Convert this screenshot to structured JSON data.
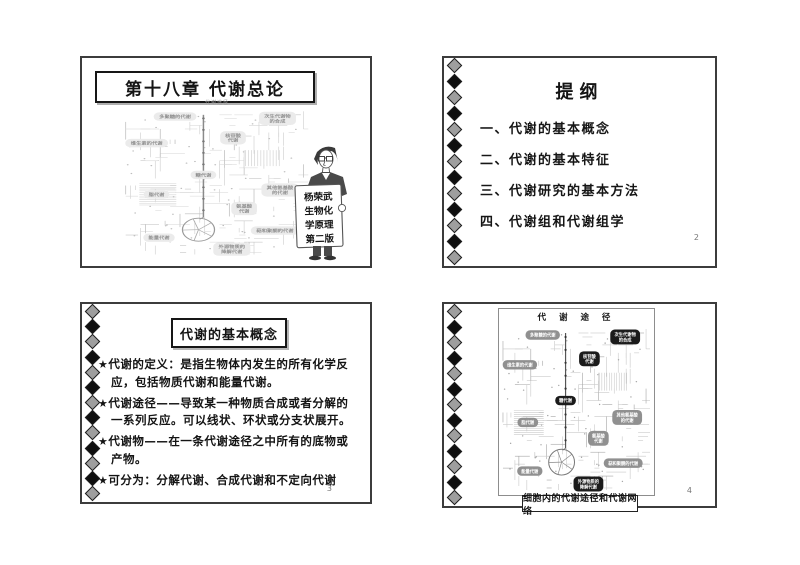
{
  "colors": {
    "slide_border": "#3c3c3c",
    "diamond_gray": "#9e9e9e",
    "diamond_black": "#0f0f0f",
    "pill_dark": "#1b1b1b",
    "pill_gray": "#909090",
    "map_line_light": "#cdcdcd"
  },
  "slides": {
    "slide1": {
      "title": "第十八章  代谢总论",
      "map_title": "代谢途径",
      "book_sign_lines": [
        "杨荣武",
        "生物化",
        "学原理",
        "第二版"
      ]
    },
    "slide2": {
      "title": "提纲",
      "items": [
        "一、代谢的基本概念",
        "二、代谢的基本特征",
        "三、代谢研究的基本方法",
        "四、代谢组和代谢组学"
      ],
      "page_number": "2"
    },
    "slide3": {
      "title": "代谢的基本概念",
      "bullet_marker": "★",
      "bullets": [
        "代谢的定义：是指生物体内发生的所有化学反应，包括物质代谢和能量代谢。",
        "代谢途径——导致某一种物质合成或者分解的一系列反应。可以线状、环状或分支状展开。",
        "代谢物——在一条代谢途径之中所有的底物或产物。",
        "可分为：分解代谢、合成代谢和不定向代谢"
      ],
      "page_number": "3"
    },
    "slide4": {
      "diagram_title": "代 谢 途 径",
      "caption": "细胞内的代谢途径和代谢网络",
      "page_number": "4",
      "map_labels": [
        {
          "lines": [
            "多聚糖的代谢"
          ],
          "x": 43,
          "y": 12,
          "dark": false
        },
        {
          "lines": [
            "次生代谢物",
            "的合成"
          ],
          "x": 126,
          "y": 14,
          "dark": true
        },
        {
          "lines": [
            "核苷酸",
            "代谢"
          ],
          "x": 90,
          "y": 36,
          "dark": true
        },
        {
          "lines": [
            "维生素的代谢"
          ],
          "x": 20,
          "y": 42,
          "dark": false
        },
        {
          "lines": [
            "糖代谢"
          ],
          "x": 66,
          "y": 78,
          "dark": true
        },
        {
          "lines": [
            "脂代谢"
          ],
          "x": 28,
          "y": 100,
          "dark": false
        },
        {
          "lines": [
            "其他氨基酸",
            "的代谢"
          ],
          "x": 128,
          "y": 95,
          "dark": false
        },
        {
          "lines": [
            "氨基酸",
            "代谢"
          ],
          "x": 99,
          "y": 116,
          "dark": false
        },
        {
          "lines": [
            "能量代谢"
          ],
          "x": 30,
          "y": 149,
          "dark": false
        },
        {
          "lines": [
            "萜和聚酮的代谢"
          ],
          "x": 124,
          "y": 141,
          "dark": false
        },
        {
          "lines": [
            "外源物质的",
            "降解代谢"
          ],
          "x": 89,
          "y": 162,
          "dark": true
        }
      ]
    }
  }
}
